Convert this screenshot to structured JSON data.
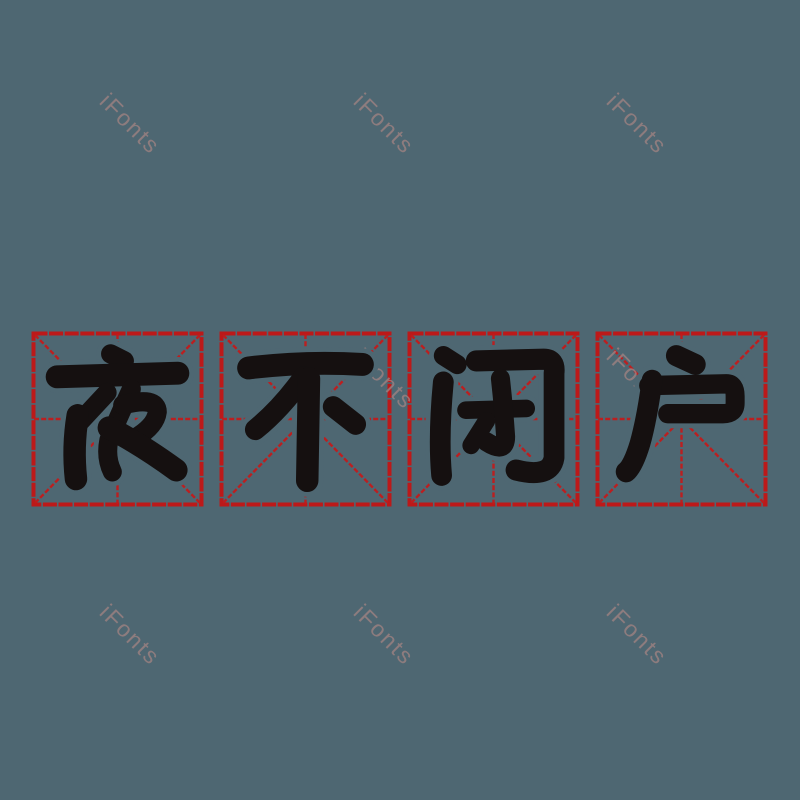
{
  "idiom": {
    "text": "夜不闭户",
    "characters": [
      "夜",
      "不",
      "闭",
      "户"
    ]
  },
  "watermark": {
    "text": "iFonts",
    "count": 9
  },
  "grid": {
    "square_count": 4,
    "style": "mi-zi-ge calligraphy practice grid"
  },
  "colors": {
    "background": "#4e6772",
    "grid_red": "#c11616",
    "ink_black": "#151010",
    "watermark_gray": "#9c8181"
  }
}
